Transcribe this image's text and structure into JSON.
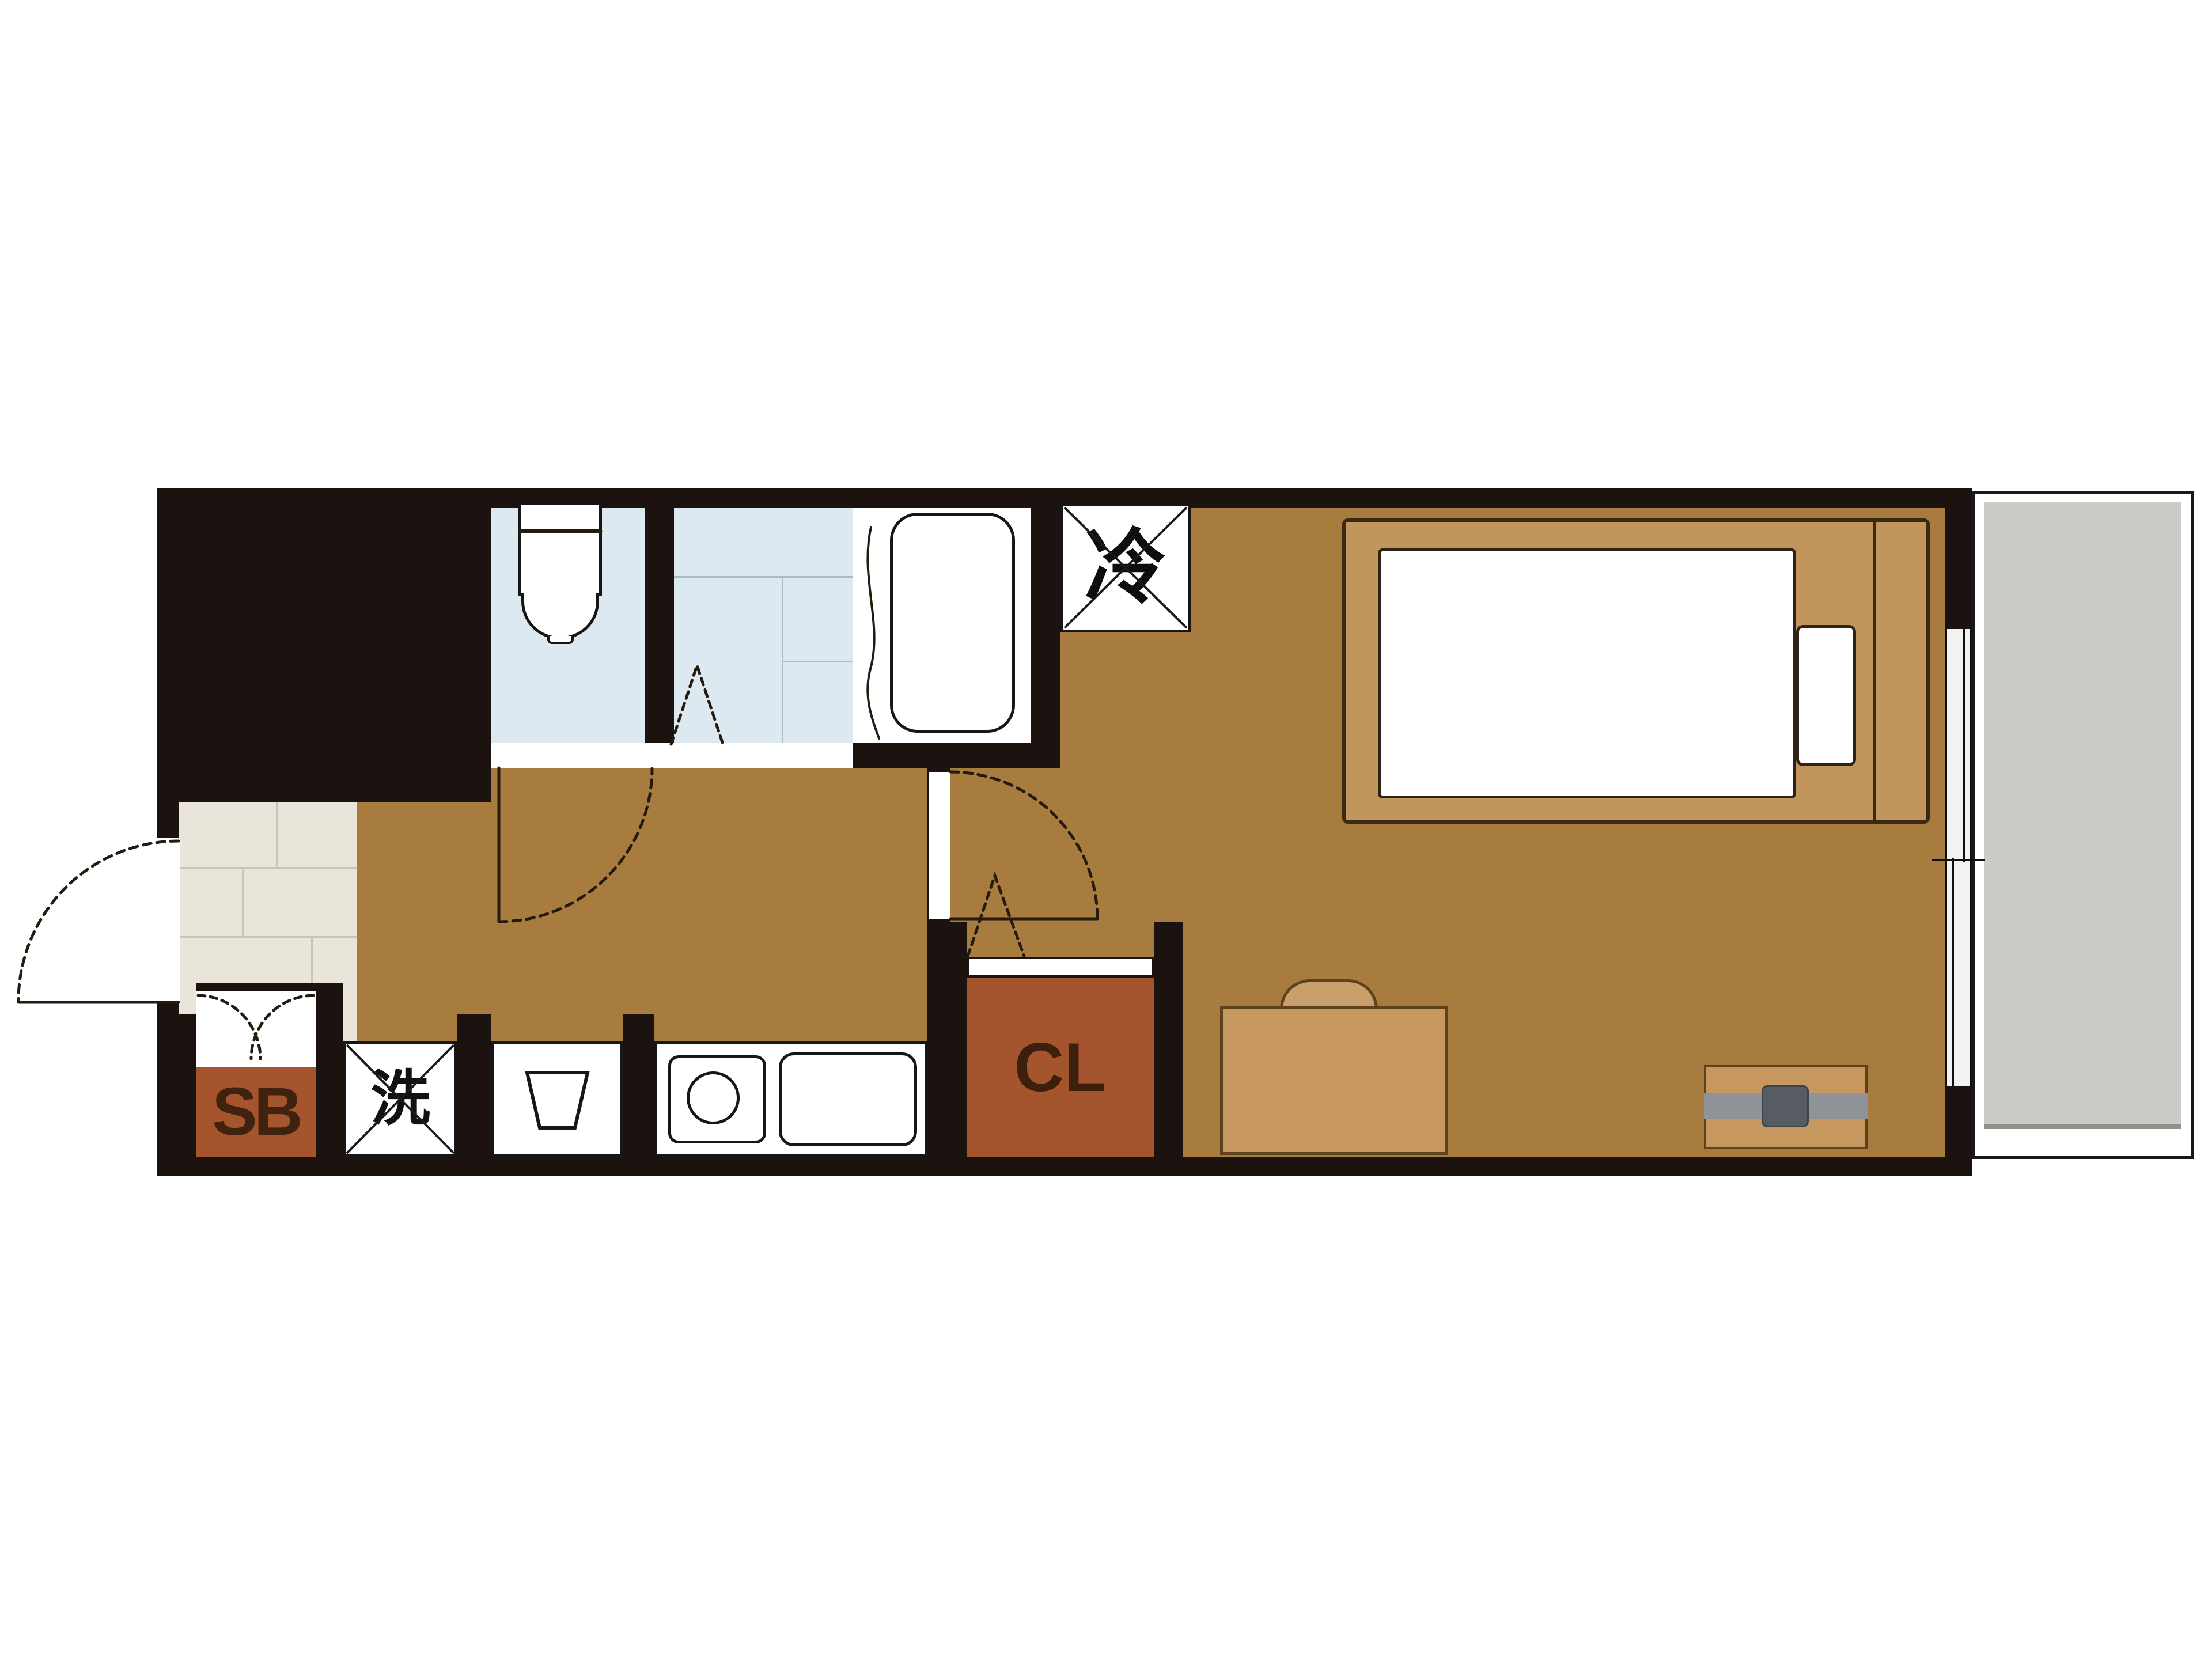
{
  "floorplan": {
    "labels": {
      "refrigerator": "冷",
      "washing_machine": "洗",
      "shoe_box": "SB",
      "closet": "CL"
    },
    "colors": {
      "wall": "#1c1310",
      "flooring": "#a87b3e",
      "entry_tile": "#e9e5da",
      "wet_area": "#dce9f1",
      "storage_box": "#a5552d",
      "furniture_wood": "#c6985f",
      "balcony_floor": "#cccbc8",
      "fixture_white": "#ffffff"
    }
  }
}
